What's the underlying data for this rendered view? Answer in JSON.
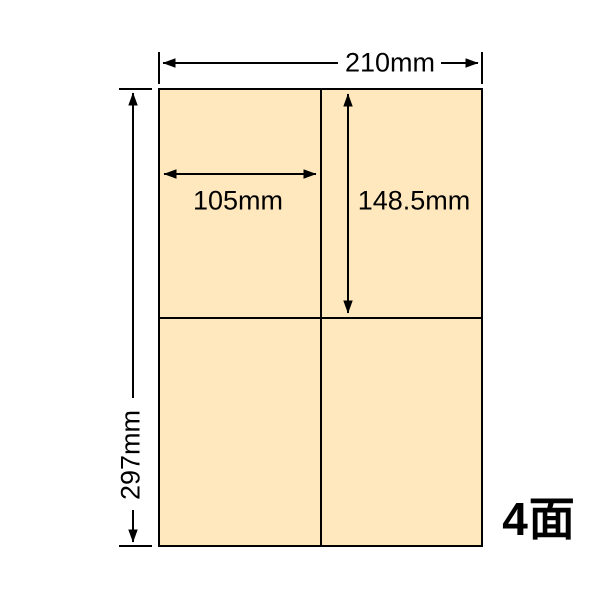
{
  "diagram": {
    "sheet_width_label": "210mm",
    "sheet_height_label": "297mm",
    "cell_width_label": "105mm",
    "cell_height_label": "148.5mm",
    "piece_count_label": "4面",
    "grid": {
      "rows": 2,
      "columns": 2,
      "cells": 4
    },
    "colors": {
      "paper_fill": "#FFE8BE",
      "line": "#000000",
      "background": "#FFFFFF"
    }
  }
}
